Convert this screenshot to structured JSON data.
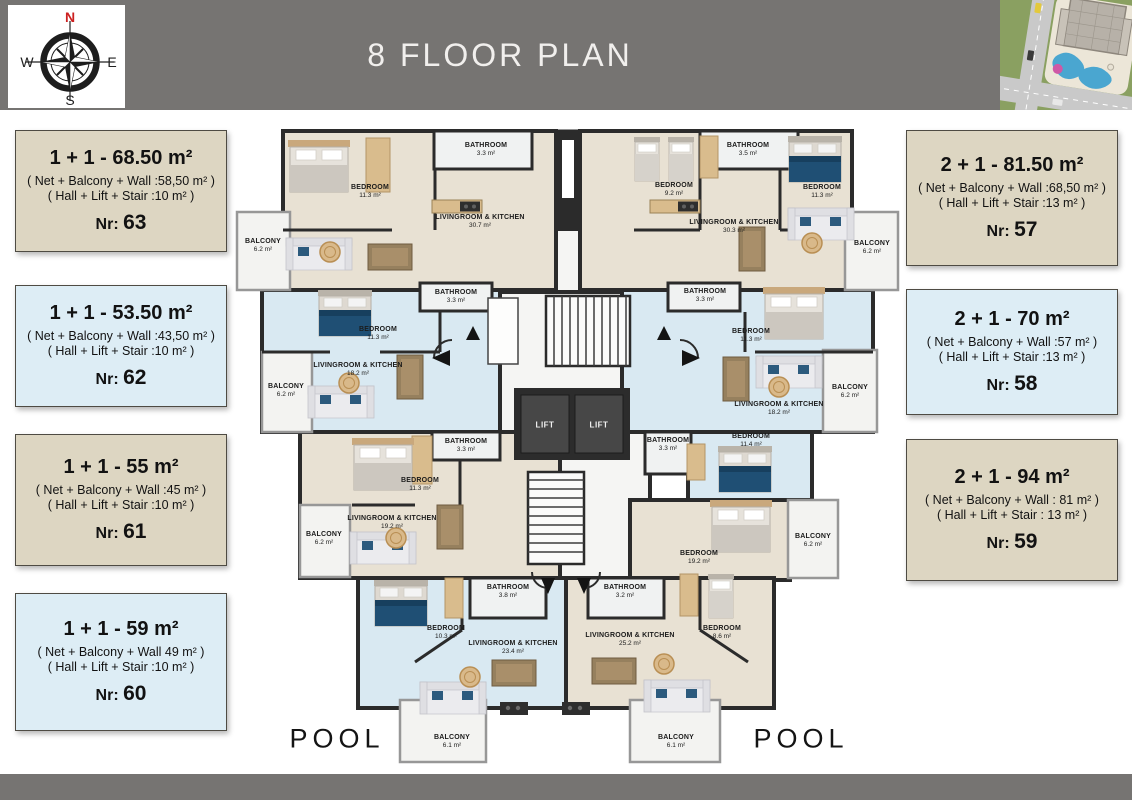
{
  "header": {
    "title": "8 FLOOR PLAN"
  },
  "compass": {
    "n": "N",
    "e": "E",
    "s": "S",
    "w": "W"
  },
  "cards_left": [
    {
      "style": "beige",
      "title": "1 + 1 - 68.50 m²",
      "line1": "( Net + Balcony + Wall :58,50 m² )",
      "line2": "( Hall + Lift + Stair :10 m² )",
      "nr_label": "Nr:",
      "nr": "63"
    },
    {
      "style": "blue",
      "title": "1 + 1 - 53.50 m²",
      "line1": "( Net + Balcony + Wall :43,50 m² )",
      "line2": "( Hall + Lift + Stair :10 m² )",
      "nr_label": "Nr:",
      "nr": "62"
    },
    {
      "style": "beige",
      "title": "1 + 1 - 55 m²",
      "line1": "( Net + Balcony + Wall :45 m² )",
      "line2": "( Hall + Lift + Stair :10 m² )",
      "nr_label": "Nr:",
      "nr": "61"
    },
    {
      "style": "blue",
      "title": "1 + 1 - 59 m²",
      "line1": "( Net + Balcony + Wall 49 m² )",
      "line2": "( Hall + Lift + Stair :10 m² )",
      "nr_label": "Nr:",
      "nr": "60"
    }
  ],
  "cards_right": [
    {
      "style": "beige",
      "title": "2 + 1 - 81.50 m²",
      "line1": "( Net + Balcony + Wall :68,50 m² )",
      "line2": "( Hall + Lift + Stair :13 m² )",
      "nr_label": "Nr:",
      "nr": "57"
    },
    {
      "style": "blue",
      "title": "2 + 1 - 70 m²",
      "line1": "( Net + Balcony + Wall :57 m² )",
      "line2": "( Hall + Lift + Stair :13 m² )",
      "nr_label": "Nr:",
      "nr": "58"
    },
    {
      "style": "beige",
      "title": "2 + 1 - 94 m²",
      "line1": "( Net + Balcony + Wall : 81 m² )",
      "line2": "( Hall + Lift + Stair : 13 m² )",
      "nr_label": "Nr:",
      "nr": "59"
    }
  ],
  "floorplan": {
    "lift1": "LIFT",
    "lift2": "LIFT",
    "pool_left": "POOL",
    "pool_right": "POOL",
    "rooms": [
      {
        "name": "BEDROOM",
        "area": "11.3 m²"
      },
      {
        "name": "BATHROOM",
        "area": "3.3 m²"
      },
      {
        "name": "LIVINGROOM & KITCHEN",
        "area": "30.7 m²"
      },
      {
        "name": "BALCONY",
        "area": "6.2 m²"
      },
      {
        "name": "BEDROOM",
        "area": "11.3 m²"
      },
      {
        "name": "BATHROOM",
        "area": "3.3 m²"
      },
      {
        "name": "LIVINGROOM & KITCHEN",
        "area": "18.2 m²"
      },
      {
        "name": "BALCONY",
        "area": "6.2 m²"
      },
      {
        "name": "BATHROOM",
        "area": "3.3 m²"
      },
      {
        "name": "BEDROOM",
        "area": "11.3 m²"
      },
      {
        "name": "LIVINGROOM & KITCHEN",
        "area": "19.2 m²"
      },
      {
        "name": "BALCONY",
        "area": "6.2 m²"
      },
      {
        "name": "BATHROOM",
        "area": "3.8 m²"
      },
      {
        "name": "BEDROOM",
        "area": "10.3 m²"
      },
      {
        "name": "LIVINGROOM & KITCHEN",
        "area": "23.4 m²"
      },
      {
        "name": "BALCONY",
        "area": "6.1 m²"
      },
      {
        "name": "BEDROOM",
        "area": "9.2 m²"
      },
      {
        "name": "BATHROOM",
        "area": "3.5 m²"
      },
      {
        "name": "BEDROOM",
        "area": "11.3 m²"
      },
      {
        "name": "LIVINGROOM & KITCHEN",
        "area": "30.3 m²"
      },
      {
        "name": "BALCONY",
        "area": "6.2 m²"
      },
      {
        "name": "BATHROOM",
        "area": "3.3 m²"
      },
      {
        "name": "BEDROOM",
        "area": "11.3 m²"
      },
      {
        "name": "LIVINGROOM & KITCHEN",
        "area": "18.2 m²"
      },
      {
        "name": "BALCONY",
        "area": "6.2 m²"
      },
      {
        "name": "BEDROOM",
        "area": "11.4 m²"
      },
      {
        "name": "BATHROOM",
        "area": "3.3 m²"
      },
      {
        "name": "BEDROOM",
        "area": "19.2 m²"
      },
      {
        "name": "BALCONY",
        "area": "6.2 m²"
      },
      {
        "name": "BATHROOM",
        "area": "3.2 m²"
      },
      {
        "name": "LIVINGROOM & KITCHEN",
        "area": "25.2 m²"
      },
      {
        "name": "BEDROOM",
        "area": "8.6 m²"
      },
      {
        "name": "BALCONY",
        "area": "6.1 m²"
      }
    ]
  },
  "colors": {
    "header_bg": "#767472",
    "card_beige": "#ddd6c2",
    "card_blue": "#ddedf5",
    "floor_beige": "#e8e1d3",
    "floor_blue": "#d9e9f2",
    "wall": "#2b2b2b",
    "pool_blue": "#4aa6d0",
    "compass_north_red": "#cc2020"
  }
}
